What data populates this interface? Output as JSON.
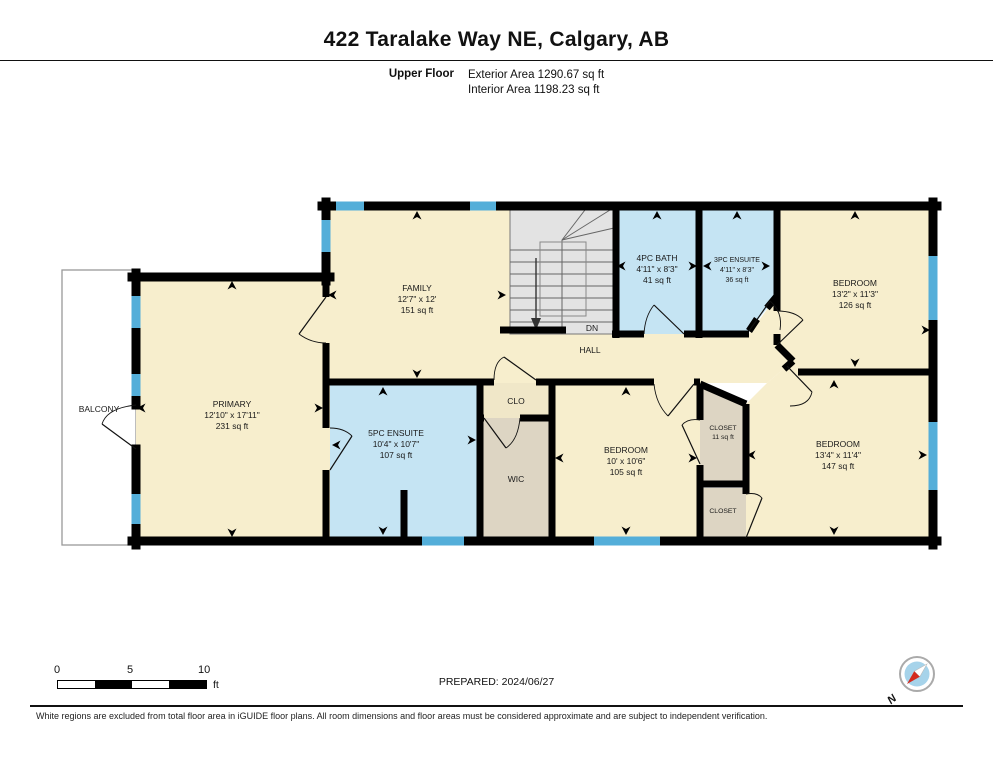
{
  "header": {
    "title": "422 Taralake Way NE, Calgary, AB",
    "floor_label": "Upper Floor",
    "exterior_area": "Exterior Area 1290.67 sq ft",
    "interior_area": "Interior Area 1198.23 sq ft"
  },
  "rooms": {
    "balcony": {
      "name": "BALCONY"
    },
    "primary": {
      "name": "PRIMARY",
      "dims": "12'10\" x 17'11\"",
      "area": "231 sq ft"
    },
    "family": {
      "name": "FAMILY",
      "dims": "12'7\" x 12'",
      "area": "151 sq ft"
    },
    "bath4pc": {
      "name": "4PC BATH",
      "dims": "4'11\" x 8'3\"",
      "area": "41 sq ft"
    },
    "ensuite3pc": {
      "name": "3PC ENSUITE",
      "dims": "4'11\" x 8'3\"",
      "area": "36 sq ft"
    },
    "bedroom_ne": {
      "name": "BEDROOM",
      "dims": "13'2\" x 11'3\"",
      "area": "126 sq ft"
    },
    "ensuite5pc": {
      "name": "5PC ENSUITE",
      "dims": "10'4\" x 10'7\"",
      "area": "107 sq ft"
    },
    "clo": {
      "name": "CLO"
    },
    "wic": {
      "name": "WIC"
    },
    "bedroom_mid": {
      "name": "BEDROOM",
      "dims": "10' x 10'6\"",
      "area": "105 sq ft"
    },
    "closet_upper": {
      "name": "CLOSET",
      "area": "11 sq ft"
    },
    "closet_lower": {
      "name": "CLOSET"
    },
    "bedroom_se": {
      "name": "BEDROOM",
      "dims": "13'4\" x 11'4\"",
      "area": "147 sq ft"
    },
    "hall": {
      "name": "HALL"
    },
    "stairs": {
      "label": "DN"
    }
  },
  "footer": {
    "prepared": "PREPARED: 2024/06/27",
    "scale_bar": {
      "tick_0": "0",
      "tick_5": "5",
      "tick_10": "10",
      "unit": "ft"
    },
    "compass": {
      "north_label": "N"
    },
    "disclaimer": "White regions are excluded from total floor area in iGUIDE floor plans. All room dimensions and floor areas must be considered approximate and are subject to independent verification."
  },
  "colors": {
    "room_fill": "#F7EECD",
    "bath_fill": "#C5E4F3",
    "closet_fill": "#DDD5C3",
    "window_blue": "#54AED9",
    "stairs_fill": "#E3E3E3",
    "wall_black": "#000000",
    "compass_red": "#D42B1E"
  }
}
